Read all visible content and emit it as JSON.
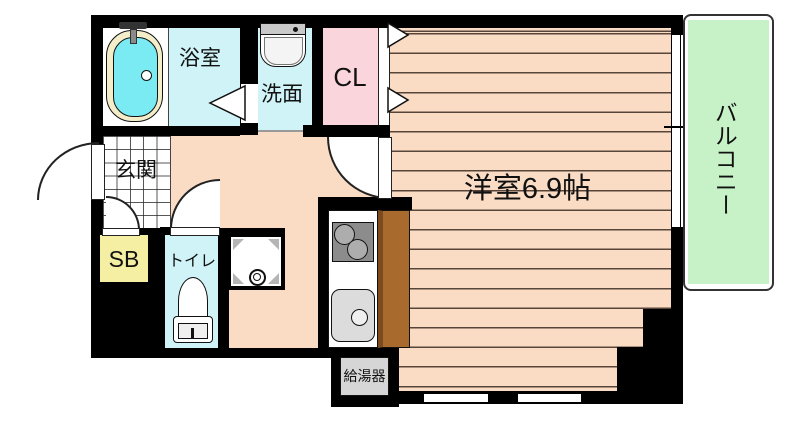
{
  "plan": {
    "title": "1R apartment floor plan",
    "rooms": {
      "bathroom": {
        "label": "浴室"
      },
      "washroom": {
        "label": "洗面"
      },
      "closet": {
        "label": "CL"
      },
      "entrance": {
        "label": "玄関"
      },
      "shoe_box": {
        "label": "SB"
      },
      "toilet": {
        "label": "トイレ"
      },
      "main_room": {
        "label": "洋室6.9帖",
        "size_tatami": 6.9
      },
      "water_heater": {
        "label": "給湯器"
      },
      "balcony": {
        "label": "バルコニー"
      }
    },
    "colors": {
      "wall": "#000000",
      "flooring": "#FADCC4",
      "wet_area": "#CFF3F7",
      "bathtub_water": "#7AEAF3",
      "bathtub_rim": "#F3EDC9",
      "closet": "#FAD6DC",
      "shoe_box": "#F4EFA3",
      "balcony": "#C7F2C7",
      "kitchen_counter": "#A96A2E",
      "heater_box": "#D6D6D6"
    }
  }
}
